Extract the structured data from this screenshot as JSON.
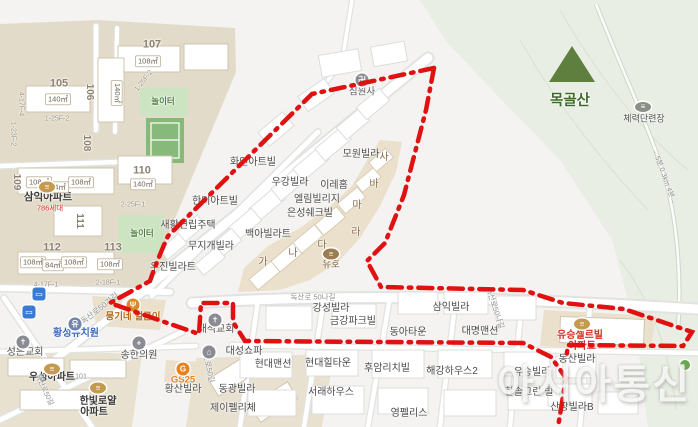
{
  "map": {
    "watermark": "아시아통신",
    "boundary_color": "#e01111",
    "region_colors": {
      "complex_beige": "#e3dbc9",
      "strip_beige": "#eae0cb",
      "park_green": "#cde4c2",
      "mountain_green": "#e8eee4",
      "road_white": "#ffffff"
    }
  },
  "labels": [
    {
      "name": "poi-simwonsa",
      "text": "심원사",
      "x": 362,
      "y": 92,
      "size": 9.5,
      "color": "#5b5b63",
      "interactable": true
    },
    {
      "name": "poi-mowon-villa",
      "text": "모원빌라",
      "x": 361,
      "y": 155,
      "interactable": true
    },
    {
      "name": "poi-hwain-artville",
      "text": "화인아트빌",
      "x": 253,
      "y": 163,
      "interactable": true
    },
    {
      "name": "poi-ugang-villa",
      "text": "우강빌라",
      "x": 290,
      "y": 183,
      "interactable": true
    },
    {
      "name": "poi-irehome",
      "text": "이레홈",
      "x": 334,
      "y": 186,
      "interactable": true
    },
    {
      "name": "poi-ellim-village",
      "text": "엘림빌리지",
      "x": 317,
      "y": 200,
      "interactable": true
    },
    {
      "name": "poi-eunseong-chekville",
      "text": "은성쉐크빌",
      "x": 310,
      "y": 214,
      "interactable": true
    },
    {
      "name": "poi-hanmi-artville",
      "text": "한미아트빌",
      "x": 215,
      "y": 202,
      "interactable": true
    },
    {
      "name": "poi-saehwal-row-house",
      "text": "새활연립주택",
      "x": 188,
      "y": 226,
      "interactable": true
    },
    {
      "name": "poi-baeka-villart",
      "text": "백아빌라트",
      "x": 268,
      "y": 235,
      "interactable": true
    },
    {
      "name": "poi-mujigae-villa",
      "text": "무지개빌라",
      "x": 211,
      "y": 247,
      "interactable": true
    },
    {
      "name": "poi-ujin-villart",
      "text": "우진빌라트",
      "x": 173,
      "y": 268,
      "interactable": true
    },
    {
      "name": "poi-yuho",
      "text": "유호",
      "x": 331,
      "y": 265,
      "size": 9.5,
      "color": "#7d5f3f",
      "interactable": true
    },
    {
      "name": "poi-gangseong-villa",
      "text": "강성빌라",
      "x": 331,
      "y": 309,
      "interactable": true
    },
    {
      "name": "poi-geumgang-park-ville",
      "text": "금강파크빌",
      "x": 353,
      "y": 322,
      "interactable": true
    },
    {
      "name": "poi-samik-villa",
      "text": "삼익빌라",
      "x": 451,
      "y": 308,
      "interactable": true
    },
    {
      "name": "poi-donga-town",
      "text": "동아타운",
      "x": 408,
      "y": 333,
      "interactable": true
    },
    {
      "name": "poi-daemyeong-mansion",
      "text": "대명맨션",
      "x": 480,
      "y": 332,
      "interactable": true
    },
    {
      "name": "poi-yuseung-selleville",
      "text": "유승셀르빌",
      "x": 580,
      "y": 336,
      "color": "#d93025",
      "weight": 600,
      "interactable": true
    },
    {
      "name": "poi-yuseung-selleville-apt",
      "text": "아파트",
      "x": 582,
      "y": 347,
      "color": "#d93025",
      "weight": 600,
      "interactable": true
    },
    {
      "name": "poi-dongsan-villa",
      "text": "동산빌라",
      "x": 577,
      "y": 360,
      "interactable": true
    },
    {
      "name": "poi-yuseung-villa",
      "text": "유승빌라",
      "x": 532,
      "y": 373,
      "interactable": true
    },
    {
      "name": "poi-hansol-green-ville",
      "text": "한솔그린 빌",
      "x": 529,
      "y": 393,
      "interactable": true
    },
    {
      "name": "poi-sanjang-villa-b",
      "text": "산장빌라B",
      "x": 572,
      "y": 408,
      "interactable": true
    },
    {
      "name": "poi-huam-richville",
      "text": "후암리치빌",
      "x": 387,
      "y": 369,
      "interactable": true
    },
    {
      "name": "poi-haegang-house2",
      "text": "해강하우스2",
      "x": 452,
      "y": 372,
      "interactable": true
    },
    {
      "name": "poi-hyundai-mansion",
      "text": "현대맨션",
      "x": 273,
      "y": 365,
      "interactable": true
    },
    {
      "name": "poi-hyundai-hilltown",
      "text": "현대힐타운",
      "x": 328,
      "y": 364,
      "interactable": true
    },
    {
      "name": "poi-seorae-house",
      "text": "서래하우스",
      "x": 331,
      "y": 393,
      "interactable": true
    },
    {
      "name": "poi-youngpellis",
      "text": "영펠리스",
      "x": 409,
      "y": 414,
      "interactable": true
    },
    {
      "name": "poi-jay-feliche",
      "text": "제이펠리체",
      "x": 233,
      "y": 409,
      "interactable": true
    },
    {
      "name": "poi-donggwang-villa",
      "text": "동광빌라",
      "x": 237,
      "y": 390,
      "interactable": true
    },
    {
      "name": "poi-hwangsan-villa",
      "text": "황산빌라",
      "x": 183,
      "y": 390,
      "interactable": true
    },
    {
      "name": "poi-gs25",
      "text": "GS25",
      "x": 183,
      "y": 380,
      "size": 9.5,
      "color": "#e8821e",
      "weight": 700,
      "interactable": true
    },
    {
      "name": "poi-daeseong-sofa",
      "text": "대성쇼파",
      "x": 244,
      "y": 352,
      "interactable": true
    },
    {
      "name": "poi-daeseok-church",
      "text": "대석교회",
      "x": 216,
      "y": 330,
      "interactable": true
    },
    {
      "name": "poi-songhan-clinic",
      "text": "송한의원",
      "x": 139,
      "y": 356,
      "interactable": true
    },
    {
      "name": "poi-seongeun-church",
      "text": "성은교회",
      "x": 25,
      "y": 353,
      "interactable": true
    },
    {
      "name": "poi-hwangseong-kindergarten",
      "text": "황성유치원",
      "x": 76,
      "y": 334,
      "color": "#3e68c0",
      "weight": 600,
      "interactable": true
    },
    {
      "name": "poi-useong-apt",
      "text": "우성아파트",
      "x": 52,
      "y": 378,
      "color": "#3a3a3a",
      "weight": 600,
      "interactable": true
    },
    {
      "name": "poi-hanbit-royal",
      "text": "한빛로얄",
      "x": 98,
      "y": 402,
      "color": "#3a3a3a",
      "weight": 600,
      "interactable": true
    },
    {
      "name": "poi-hanbit-royal-apt",
      "text": "아파트",
      "x": 94,
      "y": 413,
      "color": "#3a3a3a",
      "weight": 600,
      "interactable": true
    },
    {
      "name": "poi-samik-apt",
      "text": "삼익아파트",
      "x": 48,
      "y": 197,
      "size": 10.5,
      "color": "#3a3a3a",
      "weight": 700,
      "interactable": true
    },
    {
      "name": "samik-apt-units",
      "text": "786세대",
      "x": 50,
      "y": 208,
      "size": 7.5,
      "color": "#d93025",
      "interactable": false
    },
    {
      "name": "poi-mungine-restaurant",
      "text": "뭉기네 얼큰이",
      "x": 133,
      "y": 317,
      "size": 9.5,
      "color": "#b06a1e",
      "weight": 600,
      "interactable": true
    },
    {
      "name": "poi-mokgolsan",
      "text": "목골산",
      "x": 570,
      "y": 101,
      "size": 14.5,
      "color": "#3f6b2a",
      "weight": 700,
      "interactable": true
    },
    {
      "name": "poi-fitness-area",
      "text": "체력단련장",
      "x": 644,
      "y": 119,
      "size": 9,
      "color": "#4f4f4f",
      "interactable": true
    },
    {
      "name": "block-letter-ga",
      "text": "가",
      "x": 263,
      "y": 263,
      "color": "#8a6a4a",
      "interactable": false
    },
    {
      "name": "block-letter-na",
      "text": "나",
      "x": 293,
      "y": 254,
      "color": "#8a6a4a",
      "interactable": false
    },
    {
      "name": "block-letter-da",
      "text": "다",
      "x": 322,
      "y": 246,
      "color": "#8a6a4a",
      "interactable": false
    },
    {
      "name": "block-letter-ra",
      "text": "라",
      "x": 356,
      "y": 233,
      "color": "#8a6a4a",
      "interactable": false
    },
    {
      "name": "block-letter-ma",
      "text": "마",
      "x": 357,
      "y": 206,
      "color": "#8a6a4a",
      "interactable": false
    },
    {
      "name": "block-letter-ba",
      "text": "바",
      "x": 374,
      "y": 185,
      "color": "#8a6a4a",
      "interactable": false
    },
    {
      "name": "block-letter-sa",
      "text": "사",
      "x": 384,
      "y": 158,
      "color": "#8a6a4a",
      "interactable": false
    },
    {
      "name": "block-number",
      "text": "107",
      "x": 152,
      "y": 45,
      "size": 11,
      "color": "#8d8272",
      "weight": 700,
      "interactable": false
    },
    {
      "name": "block-number",
      "text": "105",
      "x": 59,
      "y": 84,
      "size": 11,
      "color": "#8d8272",
      "weight": 700,
      "interactable": false
    },
    {
      "name": "block-number",
      "text": "110",
      "x": 142,
      "y": 171,
      "size": 11,
      "color": "#8d8272",
      "weight": 700,
      "interactable": false
    },
    {
      "name": "block-number",
      "text": "112",
      "x": 52,
      "y": 248,
      "size": 11,
      "color": "#8d8272",
      "weight": 700,
      "interactable": false
    },
    {
      "name": "block-number",
      "text": "113",
      "x": 113,
      "y": 248,
      "size": 11,
      "color": "#8d8272",
      "weight": 700,
      "interactable": false
    },
    {
      "name": "block-number",
      "text": "106",
      "x": 89,
      "y": 92,
      "size": 10,
      "color": "#8d8272",
      "weight": 700,
      "rotate": 90,
      "interactable": false
    },
    {
      "name": "block-number",
      "text": "108",
      "x": 86,
      "y": 143,
      "size": 10,
      "color": "#8d8272",
      "weight": 700,
      "rotate": 90,
      "interactable": false
    },
    {
      "name": "block-number",
      "text": "109",
      "x": 16,
      "y": 182,
      "size": 10,
      "color": "#8d8272",
      "weight": 700,
      "rotate": 90,
      "interactable": false
    },
    {
      "name": "block-number",
      "text": "111",
      "x": 79,
      "y": 221,
      "size": 10,
      "color": "#8d8272",
      "weight": 700,
      "rotate": 90,
      "interactable": false
    },
    {
      "name": "area-label",
      "text": "108㎡",
      "x": 148,
      "y": 61,
      "cls": "boxed",
      "size": 7.5,
      "color": "#6d6352",
      "interactable": false
    },
    {
      "name": "area-label",
      "text": "140㎡",
      "x": 58,
      "y": 99,
      "cls": "boxed",
      "size": 7.5,
      "color": "#6d6352",
      "interactable": false
    },
    {
      "name": "area-label",
      "text": "140㎡",
      "x": 117,
      "y": 93,
      "cls": "boxed",
      "size": 7.5,
      "color": "#6d6352",
      "rotate": 90,
      "interactable": false
    },
    {
      "name": "area-label",
      "text": "140㎡",
      "x": 143,
      "y": 184,
      "cls": "boxed",
      "size": 7.5,
      "color": "#6d6352",
      "interactable": false
    },
    {
      "name": "area-label",
      "text": "108㎡",
      "x": 39,
      "y": 182,
      "cls": "boxed",
      "size": 7.5,
      "color": "#6d6352",
      "interactable": false
    },
    {
      "name": "area-label",
      "text": "84㎡",
      "x": 58,
      "y": 187,
      "cls": "boxed",
      "size": 7.5,
      "color": "#6d6352",
      "interactable": false
    },
    {
      "name": "area-label",
      "text": "108㎡",
      "x": 81,
      "y": 182,
      "cls": "boxed",
      "size": 7.5,
      "color": "#6d6352",
      "interactable": false
    },
    {
      "name": "area-label",
      "text": "108㎡",
      "x": 33,
      "y": 262,
      "cls": "boxed",
      "size": 7.5,
      "color": "#6d6352",
      "interactable": false
    },
    {
      "name": "area-label",
      "text": "84㎡",
      "x": 53,
      "y": 265,
      "cls": "boxed",
      "size": 7.5,
      "color": "#6d6352",
      "interactable": false
    },
    {
      "name": "area-label",
      "text": "108㎡",
      "x": 74,
      "y": 262,
      "cls": "boxed",
      "size": 7.5,
      "color": "#6d6352",
      "interactable": false
    },
    {
      "name": "area-label",
      "text": "108㎡",
      "x": 110,
      "y": 264,
      "cls": "boxed",
      "size": 7.5,
      "color": "#6d6352",
      "interactable": false
    },
    {
      "name": "block-code",
      "text": "1-25F-2",
      "x": 57,
      "y": 119,
      "size": 7,
      "color": "#9a9181",
      "interactable": false
    },
    {
      "name": "block-code",
      "text": "1-25F-2",
      "x": 144,
      "y": 81,
      "size": 7,
      "color": "#9a9181",
      "rotate": -52,
      "interactable": false
    },
    {
      "name": "block-code",
      "text": "2-25F-1",
      "x": 133,
      "y": 205,
      "size": 7,
      "color": "#9a9181",
      "interactable": false
    },
    {
      "name": "block-code",
      "text": "4-17F-4",
      "x": 21,
      "y": 104,
      "size": 7,
      "color": "#9a9181",
      "rotate": 90,
      "interactable": false
    },
    {
      "name": "block-code",
      "text": "1-23F-2",
      "x": 13,
      "y": 134,
      "size": 7,
      "color": "#9a9181",
      "rotate": 90,
      "interactable": false
    },
    {
      "name": "block-code",
      "text": "4-17F-1",
      "x": 46,
      "y": 285,
      "size": 7,
      "color": "#9a9181",
      "interactable": false
    },
    {
      "name": "block-code",
      "text": "2-18F-1",
      "x": 108,
      "y": 283,
      "size": 7,
      "color": "#9a9181",
      "interactable": false
    },
    {
      "name": "road-label",
      "text": "독산로50가길",
      "x": 100,
      "y": 309,
      "size": 8,
      "color": "#8f8f8f",
      "rotate": -38,
      "interactable": false
    },
    {
      "name": "road-label",
      "text": "독산로 50나길",
      "x": 313,
      "y": 297,
      "size": 7.5,
      "color": "#8f8f8f",
      "interactable": false
    },
    {
      "name": "road-label",
      "text": "독산로50나길",
      "x": 495,
      "y": 308,
      "size": 7.5,
      "color": "#8f8f8f",
      "rotate": 72,
      "interactable": false
    },
    {
      "name": "road-label",
      "text": "독산로50길",
      "x": 208,
      "y": 365,
      "size": 7.5,
      "color": "#8f8f8f",
      "rotate": 78,
      "interactable": false
    },
    {
      "name": "road-label",
      "text": "독산로50길",
      "x": 44,
      "y": 390,
      "size": 7,
      "color": "#8f8f8f",
      "rotate": 65,
      "interactable": false
    },
    {
      "name": "road-label",
      "text": "101",
      "x": 81,
      "y": 377,
      "size": 7,
      "color": "#8f8f8f",
      "interactable": false
    },
    {
      "name": "playground-label",
      "text": "놀이터",
      "x": 163,
      "y": 101,
      "size": 8.5,
      "color": "#4e7d3e",
      "weight": 600,
      "interactable": false
    },
    {
      "name": "playground-label",
      "text": "놀이터",
      "x": 142,
      "y": 233,
      "size": 8.5,
      "color": "#4e7d3e",
      "weight": 600,
      "interactable": false
    },
    {
      "name": "trail-label",
      "text": "←5분 0.3km 4분→",
      "x": 664,
      "y": 177,
      "size": 7,
      "color": "#8a8a8a",
      "rotate": 70,
      "interactable": false
    }
  ],
  "icons": [
    {
      "name": "temple-icon",
      "x": 362,
      "y": 80,
      "w": 13,
      "h": 13,
      "shape": "circle",
      "bg": "#8b8b93",
      "glyph": "卍",
      "interactable": true
    },
    {
      "name": "church-icon",
      "x": 215,
      "y": 320,
      "w": 13,
      "h": 13,
      "shape": "circle",
      "bg": "#8b8b93",
      "glyph": "✝",
      "interactable": true
    },
    {
      "name": "church-icon",
      "x": 23,
      "y": 342,
      "w": 13,
      "h": 13,
      "shape": "circle",
      "bg": "#8b8b93",
      "glyph": "✝",
      "interactable": true
    },
    {
      "name": "clinic-icon",
      "x": 139,
      "y": 343,
      "w": 13,
      "h": 13,
      "shape": "circle",
      "bg": "#8b8b93",
      "glyph": "+",
      "interactable": true
    },
    {
      "name": "kindergarten-icon",
      "x": 75,
      "y": 324,
      "w": 13,
      "h": 13,
      "shape": "circle",
      "bg": "#6f84a8",
      "glyph": "유",
      "interactable": true
    },
    {
      "name": "sofa-shop-icon",
      "x": 209,
      "y": 352,
      "w": 13,
      "h": 13,
      "shape": "circle",
      "bg": "#8b8b93",
      "glyph": "⌂",
      "interactable": true
    },
    {
      "name": "gs25-icon",
      "x": 183,
      "y": 369,
      "w": 13,
      "h": 13,
      "shape": "circle",
      "bg": "#e8821e",
      "glyph": "G",
      "interactable": true
    },
    {
      "name": "restaurant-icon",
      "x": 133,
      "y": 305,
      "w": 13,
      "h": 13,
      "shape": "circle",
      "bg": "#d98a2b",
      "glyph": "Ψ",
      "interactable": true
    },
    {
      "name": "restaurant-icon",
      "x": 331,
      "y": 254,
      "w": 16,
      "h": 11,
      "shape": "oval",
      "bg": "#9b7d4f",
      "glyph": "≡",
      "interactable": true
    },
    {
      "name": "apartment-icon",
      "x": 47,
      "y": 187,
      "w": 16,
      "h": 11,
      "shape": "oval",
      "bg": "#c49a4e",
      "glyph": "≡",
      "interactable": true
    },
    {
      "name": "apartment-icon",
      "x": 52,
      "y": 369,
      "w": 16,
      "h": 11,
      "shape": "oval",
      "bg": "#c49a4e",
      "glyph": "≡",
      "interactable": true
    },
    {
      "name": "apartment-icon",
      "x": 98,
      "y": 388,
      "w": 16,
      "h": 11,
      "shape": "oval",
      "bg": "#c49a4e",
      "glyph": "≡",
      "interactable": true
    },
    {
      "name": "apartment-icon",
      "x": 582,
      "y": 324,
      "w": 16,
      "h": 11,
      "shape": "oval",
      "bg": "#c49a4e",
      "glyph": "≡",
      "interactable": true
    },
    {
      "name": "bus-stop-icon",
      "x": 39,
      "y": 294,
      "w": 13,
      "h": 13,
      "shape": "square",
      "bg": "#3a7bd5",
      "glyph": "▭",
      "interactable": true
    },
    {
      "name": "bus-stop-icon",
      "x": 29,
      "y": 312,
      "w": 13,
      "h": 13,
      "shape": "square",
      "bg": "#3a7bd5",
      "glyph": "▭",
      "interactable": true
    },
    {
      "name": "fitness-icon",
      "x": 643,
      "y": 107,
      "w": 16,
      "h": 10,
      "shape": "oval",
      "bg": "#8b9086",
      "glyph": "≡",
      "interactable": true
    },
    {
      "name": "park-icon",
      "x": 685,
      "y": 365,
      "w": 10,
      "h": 10,
      "shape": "circle",
      "bg": "#6aa84f",
      "glyph": "",
      "interactable": true
    }
  ]
}
